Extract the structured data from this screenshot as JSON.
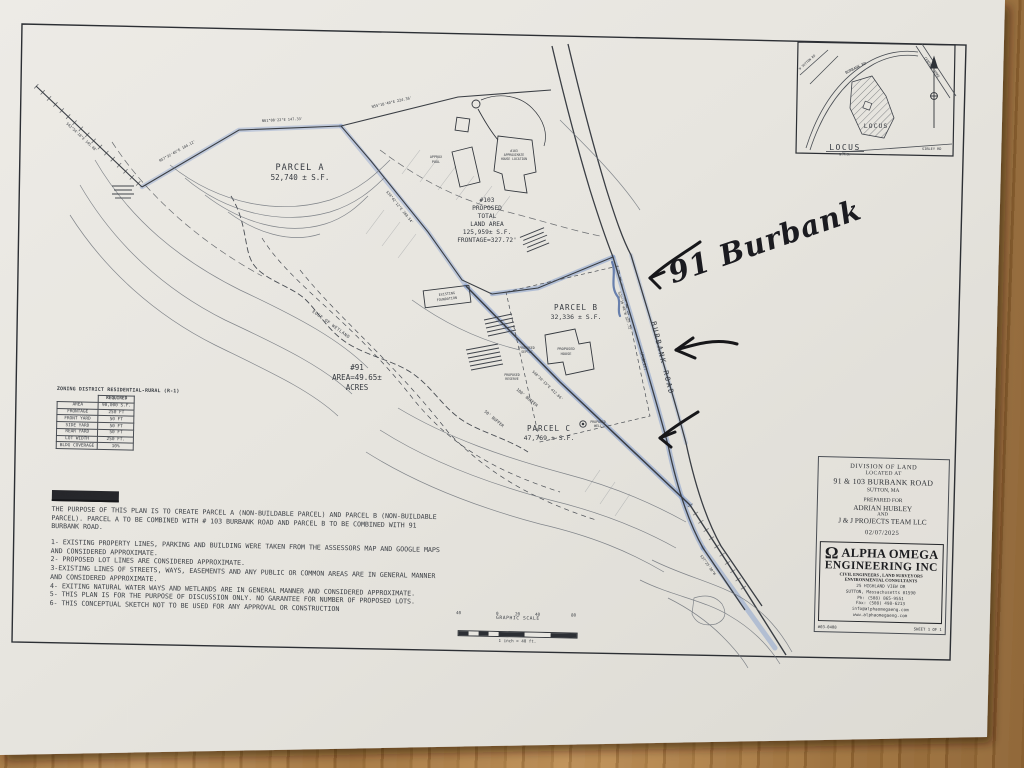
{
  "photo": {
    "wood_color": "#ac7b42",
    "paper_color": "#e8e6e0"
  },
  "plan": {
    "parcel_a": {
      "title": "PARCEL A",
      "area": "52,740 ± S.F."
    },
    "parcel_b": {
      "title": "PARCEL B",
      "area": "32,336 ± S.F."
    },
    "parcel_c": {
      "title": "PARCEL C",
      "area": "47,769 ± S.F."
    },
    "lot_103": [
      "#103",
      "PROPOSED",
      "TOTAL",
      "LAND AREA",
      "125,959± S.F.",
      "FRONTAGE=327.72'"
    ],
    "lot_91": [
      "#91",
      "AREA=49.65±",
      "ACRES"
    ],
    "road": {
      "name": "BURBANK ROAD",
      "type": "(PUBLIC)"
    },
    "features": {
      "existing_foundation": [
        "EXISTING",
        "FOUNDATION"
      ],
      "house_103": [
        "#103",
        "APPROXIMATE",
        "HOUSE LOCATION"
      ],
      "pool": [
        "APPROX",
        "POOL"
      ],
      "proposed_house": [
        "PROPOSED",
        "HOUSE"
      ],
      "proposed_septic": [
        "PROPOSED",
        "SEPTIC"
      ],
      "proposed_reserve": [
        "PROPOSED",
        "RESERVE"
      ],
      "proposed_well": [
        "PROPOSED",
        "WELL"
      ],
      "edge_of_wetland": "EDGE OF WETLAND",
      "buffer_100": "100' BUFFER",
      "buffer_50": "50' BUFFER"
    },
    "bearings": [
      "S62°54'18\"E 145.48'",
      "N57°32'46\"E 184.12'",
      "N61°08'22\"E 147.33'",
      "N55°18'40\"E 224.36'",
      "S34°42'12\"E 268.54'",
      "S22°16'48\"W 327.72'",
      "S48°20'15\"E 412.66'",
      "S37°25'30\"W"
    ]
  },
  "locus": {
    "label_inside": "LOCUS",
    "title": "LOCUS",
    "nts": "N.T.S.",
    "roads": [
      "BURBANK RD",
      "SIBLEY RD",
      "CENTRAL TPKE",
      "W SUTTON RD"
    ]
  },
  "zoning": {
    "title": "ZONING DISTRICT RESIDENTIAL-RURAL (R-1)",
    "header": "REQUIRED",
    "rows": [
      [
        "AREA",
        "90,000 S.F."
      ],
      [
        "FRONTAGE",
        "250 FT"
      ],
      [
        "FRONT YARD",
        "50 FT"
      ],
      [
        "SIDE YARD",
        "50 FT"
      ],
      [
        "REAR YARD",
        "50 FT"
      ],
      [
        "LOT WIDTH",
        "250 FT."
      ],
      [
        "BLDG COVERAGE",
        "10%"
      ]
    ]
  },
  "notes": {
    "title": "CONCEPTUAL PLAN",
    "paragraph": "THE PURPOSE OF THIS PLAN IS TO CREATE PARCEL A (NON-BUILDABLE PARCEL) AND PARCEL B (NON-BUILDABLE PARCEL). PARCEL A TO BE COMBINED WITH # 103 BURBANK ROAD AND PARCEL B TO BE COMBINED WITH 91 BURBANK ROAD.",
    "items": [
      "1- EXISTING PROPERTY LINES, PARKING AND BUILDING WERE TAKEN FROM THE ASSESSORS MAP AND GOOGLE MAPS AND CONSIDERED APPROXIMATE.",
      "2- PROPOSED LOT LINES ARE CONSIDERED APPROXIMATE.",
      "3-EXISTING LINES OF STREETS, WAYS, EASEMENTS AND ANY PUBLIC OR COMMON AREAS ARE IN GENERAL MANNER AND CONSIDERED APPROXIMATE.",
      "4- EXITING NATURAL WATER WAYS AND WETLANDS ARE IN GENERAL MANNER AND CONSIDERED APPROXIMATE.",
      "5- THIS PLAN IS FOR THE PURPOSE OF DISCUSSION ONLY. NO GARANTEE FOR NUMBER OF PROPOSED LOTS.",
      "6- THIS CONCEPTUAL SKETCH NOT TO BE USED FOR ANY APPROVAL OR CONSTRUCTION"
    ]
  },
  "scale_bar": {
    "title": "GRAPHIC SCALE",
    "ticks": [
      "40",
      "0",
      "20",
      "40",
      "80"
    ],
    "caption": "1 inch = 40 ft."
  },
  "title_block": {
    "lines": [
      "DIVISION OF LAND",
      "LOCATED AT",
      "91 & 103 BURBANK ROAD",
      "SUTTON, MA",
      "PREPARED FOR",
      "ADRIAN HUBLEY",
      "AND",
      "J & J PROJECTS TEAM LLC",
      "02/07/2025"
    ]
  },
  "firm": {
    "logo_glyph": "Ω",
    "name1": "ALPHA OMEGA",
    "name2": "ENGINEERING INC",
    "sub1": "CIVIL ENGINEERS , LAND SURVEYORS",
    "sub2": "ENVIRONMENTAL CONSULTANTS",
    "addr": [
      "25 HIGHLAND VIEW DR",
      "SUTTON, Massachusetts 01590",
      "Ph: (508) 865-9551",
      "Fax: (508) 498-6213",
      "info@alphaomegaeng.com",
      "www.alphaomegaeng.com"
    ],
    "job_no": "#03-0408",
    "sheet": "SHEET 1 OF 1"
  },
  "annotations": {
    "handwritten_label": "91 Burbank"
  }
}
